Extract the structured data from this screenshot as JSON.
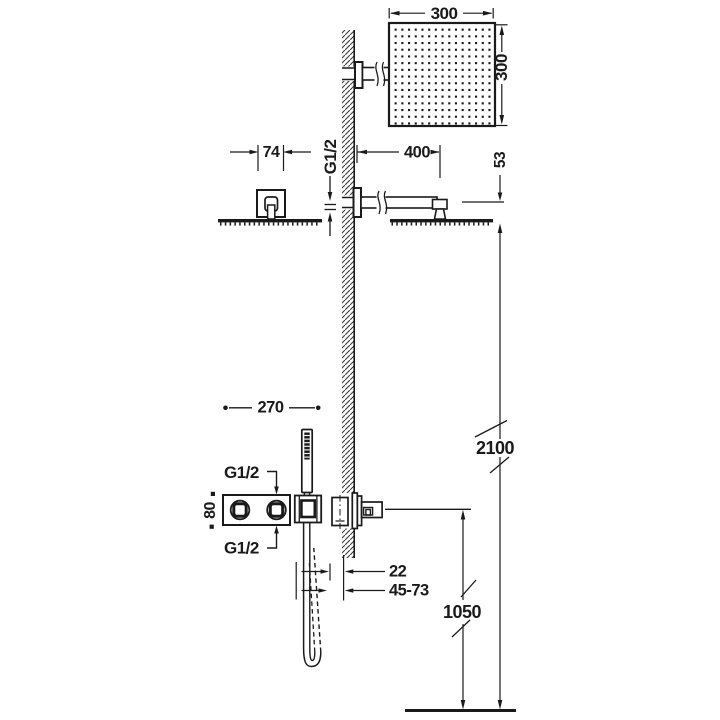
{
  "diagram": {
    "kind": "shower installation technical drawing",
    "units": "mm"
  },
  "labels": {
    "head_width": "300",
    "head_height": "300",
    "arm_flange_width": "74",
    "arm_thread": "G1/2",
    "arm_length": "400",
    "head_drop": "53",
    "total_height": "2100",
    "valve_to_holder": "270",
    "valve_plate_height": "80",
    "valve_thread_top": "G1/2",
    "valve_thread_bottom": "G1/2",
    "outlet_offset": "22",
    "outlet_range": "45-73",
    "outlet_height": "1050"
  },
  "colors": {
    "line": "#1a1a1a",
    "background": "#ffffff"
  }
}
